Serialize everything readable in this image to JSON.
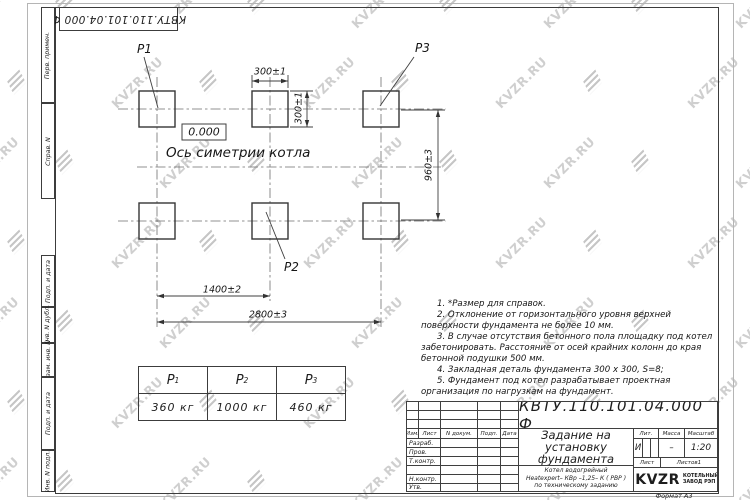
{
  "watermark": {
    "text": "KVZR.RU"
  },
  "top_stamp": {
    "doc_number": "КВТУ.110.101.04.000  Ф"
  },
  "side_column": {
    "labels": [
      "Перв. примен.",
      "Справ. N",
      "Подп. и дата",
      "Инв. N дубл.",
      "Взам. инв. N",
      "Подп. и дата",
      "Инв. N подл."
    ]
  },
  "drawing": {
    "pad_labels": [
      "P1",
      "P2",
      "P3"
    ],
    "elevation_mark": "0.000",
    "axis_label": "Ось симетрии котла",
    "dim_pad_width": "300±1",
    "dim_pad_height": "300±1",
    "dim_row_spacing": "960±3",
    "dim_mid_spacing": "1400±2",
    "dim_overall": "2800±3"
  },
  "notes": [
    "1.  *Размер для справок.",
    "2.  Отклонение от горизонтального уровня верхней поверхности фундамента не более 10 мм.",
    "3.  В случае отсутствия бетонного пола площадку под котел забетонировать. Расстояние от осей крайних колонн до края бетонной подушки 500 мм.",
    "4.  Закладная деталь фундамента  300 х 300,  S=8;",
    "5.  Фундамент под котел разрабатывает проектная организация по нагрузкам на фундамент."
  ],
  "load_table": {
    "headers": [
      {
        "base": "P",
        "sub": "1"
      },
      {
        "base": "P",
        "sub": "2"
      },
      {
        "base": "P",
        "sub": "3"
      }
    ],
    "values": [
      "360  кг",
      "1000  кг",
      "460  кг"
    ]
  },
  "title_block": {
    "doc_number": "КВТУ.110.101.04.000  Ф",
    "title_lines": [
      "Задание на",
      "установку",
      "фундамента"
    ],
    "subtitle_lines": [
      "Котел водогрейный",
      "Heatexpert– КВр –1,25– К ( РВР )",
      "по техническому заданию"
    ],
    "col_headers": [
      "Изм.",
      "Лист",
      "N докум.",
      "Подп.",
      "Дата"
    ],
    "row_labels": [
      "Разраб.",
      "Пров.",
      "Т.контр.",
      "",
      "Н.контр.",
      "Утв."
    ],
    "lit_headers": [
      "Лит.",
      "Масса",
      "Масштаб"
    ],
    "lit_value": "И",
    "mass_value": "–",
    "scale_value": "1:20",
    "sheet_label": "Лист",
    "sheets_label": "Листов",
    "sheets_value": "1",
    "logo_text": "KVZR",
    "logo_caption": [
      "КОТЕЛЬНЫЙ",
      "ЗАВОД РЭП"
    ],
    "format_label": "Формат А3"
  }
}
